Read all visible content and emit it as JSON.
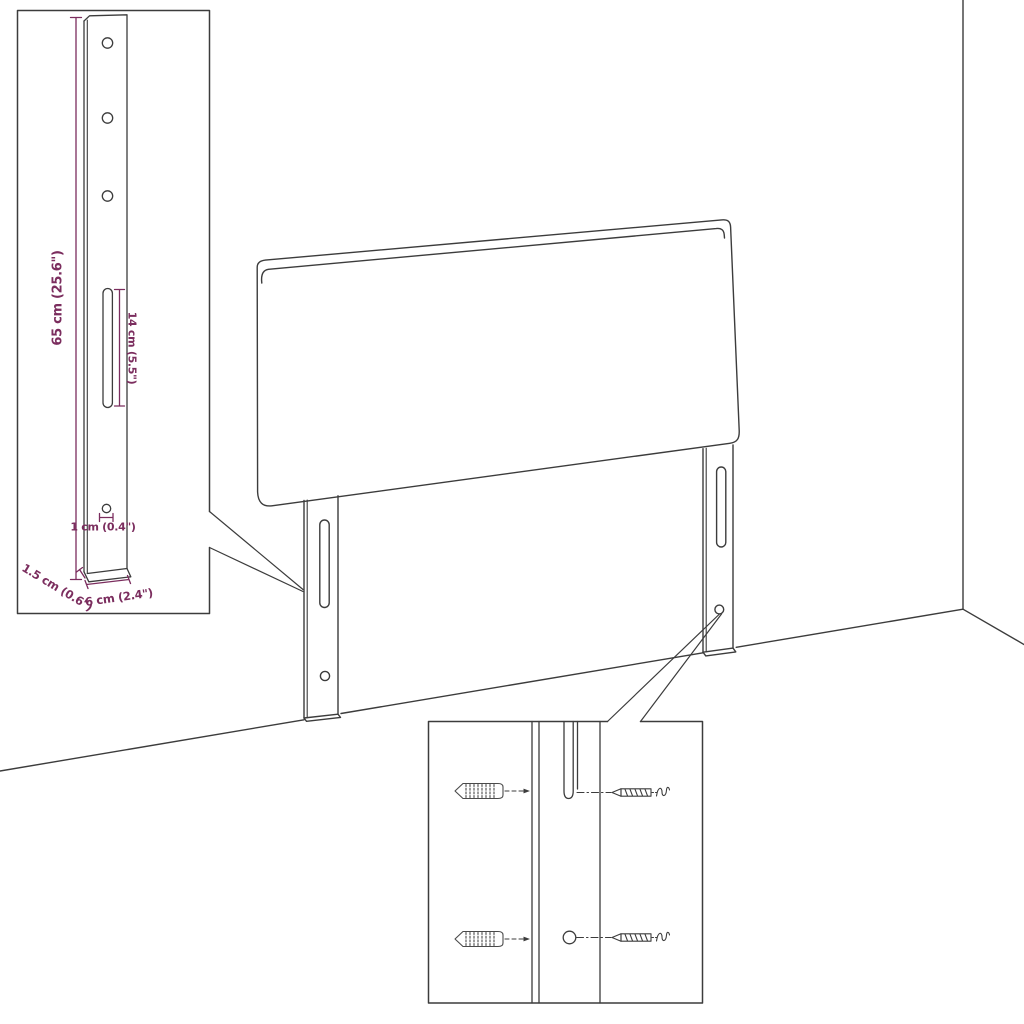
{
  "diagram": {
    "kind": "headboard-assembly-dimension-diagram",
    "colors": {
      "background": "#ffffff",
      "line_art": "#3c3c3c",
      "dimension_accent": "#7b2d5e"
    },
    "labels": {
      "bracket_height": "65 cm (25.6\")",
      "slot_length": "14 cm (5.5\")",
      "hole_diameter": "1 cm (0.4\")",
      "bracket_depth": "1.5 cm (0.6\")",
      "bracket_width": "6 cm (2.4\")"
    }
  }
}
